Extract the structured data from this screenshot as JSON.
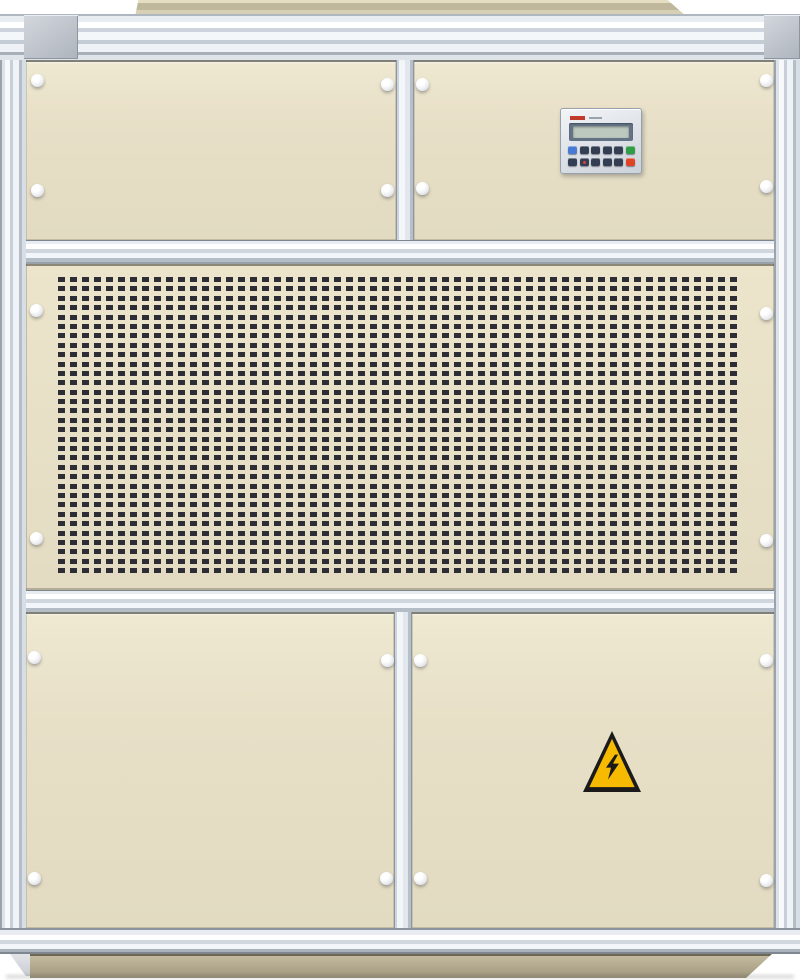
{
  "image": {
    "kind": "photograph",
    "subject": "beige industrial air-handling / dehumidifier cabinet with aluminum frame",
    "background_color": "#ffffff"
  },
  "palette": {
    "panel_beige": "#e7dfc6",
    "panel_beige_light": "#efe9d2",
    "aluminum_light": "#f6f8fb",
    "aluminum_mid": "#ccd3dc",
    "aluminum_dark": "#9aa2ad",
    "corner_cap": "#c2c7cf",
    "roof_tan": "#cfc7ab",
    "base_tan": "#b4ab91",
    "slot_dark": "#2d2d35",
    "knob_white": "#f3f4f6"
  },
  "sections": {
    "upper_panels": 2,
    "grille_panels": 1,
    "lower_doors": 2
  },
  "grille": {
    "rows": 32,
    "cols": 57,
    "slot_width_px": 7,
    "slot_pitch_px": 12
  },
  "keypad": {
    "brand_mark_color": "#c03a2b",
    "lcd": {
      "bezel_color": "#647285",
      "screen_color": "#bdc9be",
      "text": ""
    },
    "button_rows": [
      [
        "blue",
        "dark",
        "dark",
        "dark",
        "dark",
        "green"
      ],
      [
        "dark",
        "dark-dot",
        "dark",
        "dark",
        "dark",
        "red"
      ]
    ],
    "button_colors": {
      "blue": "#4a7bd4",
      "dark": "#333e52",
      "dark-dot": "#333e52",
      "green": "#2f9e44",
      "red": "#e04426"
    }
  },
  "warning_sign": {
    "symbol": "lightning-bolt",
    "meaning": "electrical-hazard",
    "bg_color": "#f6bb00",
    "fg_color": "#1a1a1a"
  },
  "fasteners": {
    "count": 20,
    "positions": [
      [
        37,
        80
      ],
      [
        387,
        84
      ],
      [
        422,
        84
      ],
      [
        766,
        80
      ],
      [
        37,
        190
      ],
      [
        387,
        190
      ],
      [
        422,
        188
      ],
      [
        766,
        186
      ],
      [
        36,
        310
      ],
      [
        766,
        313
      ],
      [
        36,
        538
      ],
      [
        766,
        540
      ],
      [
        34,
        657
      ],
      [
        387,
        660
      ],
      [
        420,
        660
      ],
      [
        766,
        660
      ],
      [
        34,
        878
      ],
      [
        386,
        878
      ],
      [
        420,
        878
      ],
      [
        766,
        880
      ]
    ]
  }
}
